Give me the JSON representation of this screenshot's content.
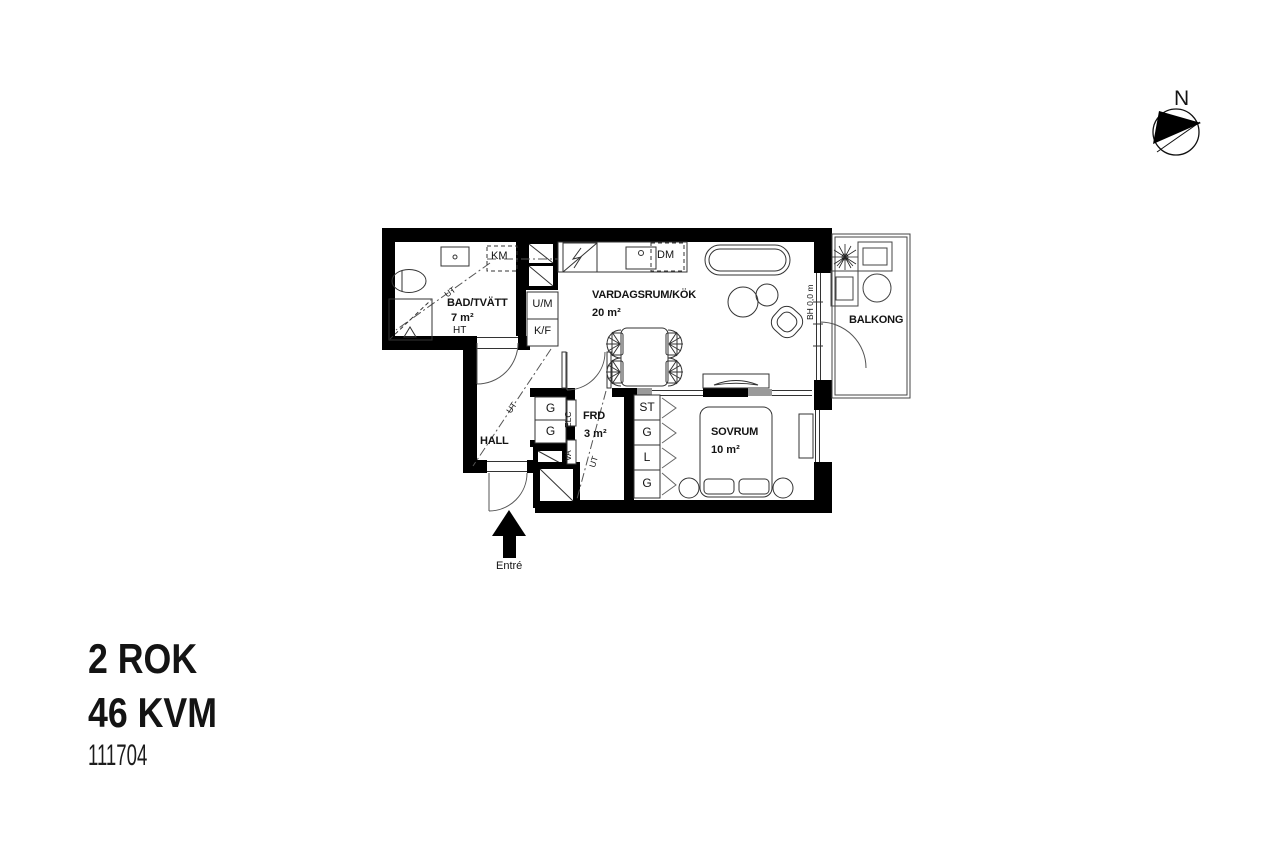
{
  "title_block": {
    "rooms_label": "2 ROK",
    "area_label": "46 KVM",
    "unit_number": "111704"
  },
  "compass": {
    "north": "N"
  },
  "entrance": {
    "label": "Entré"
  },
  "common": {
    "ut": "UT"
  },
  "bathroom": {
    "name": "BAD/TVÄTT",
    "area": "7 m²",
    "towel_dryer": "HT",
    "washer": "KM"
  },
  "kitchen": {
    "micro": "U/M",
    "fridge": "K/F",
    "dishwasher": "DM"
  },
  "living": {
    "name": "VARDAGSRUM/KÖK",
    "area": "20 m²"
  },
  "hall": {
    "name": "HALL",
    "closet_top": "G",
    "closet_bottom": "G"
  },
  "storage": {
    "name": "FRD",
    "area": "3 m²",
    "electrical": "ELC",
    "water": "VA"
  },
  "bedroom": {
    "name": "SOVRUM",
    "area": "10 m²",
    "closets": [
      "ST",
      "G",
      "L",
      "G"
    ]
  },
  "balcony": {
    "name": "BALKONG",
    "sill_height": "BH 0,0 m"
  },
  "colors": {
    "wall": "#000000",
    "partition_gray": "#9a9a9a",
    "line": "#333333"
  }
}
